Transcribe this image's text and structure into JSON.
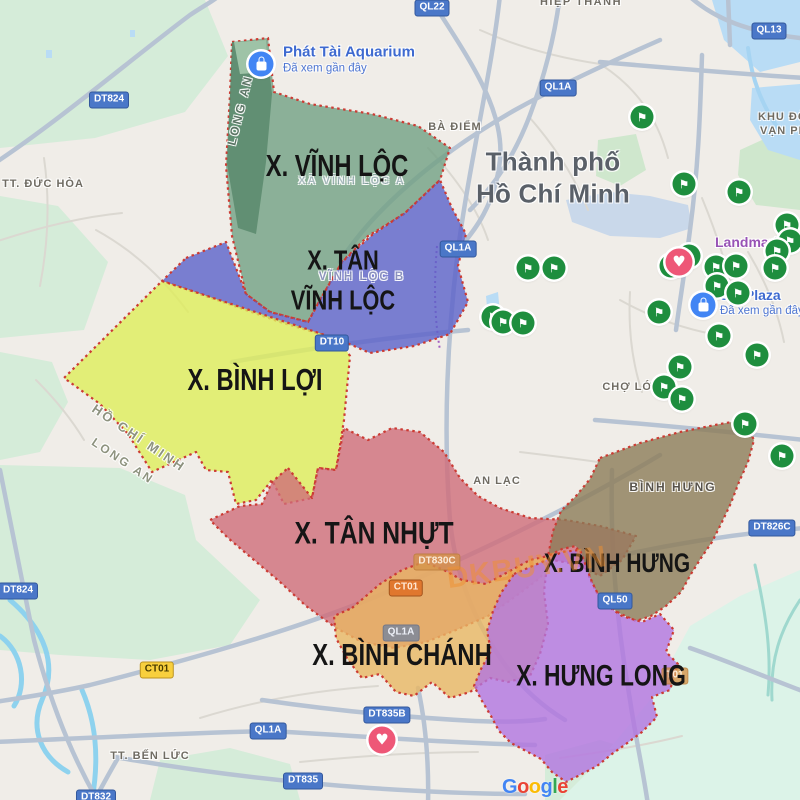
{
  "map": {
    "attribution": {
      "text": "Google",
      "x": 502,
      "y": 776,
      "letter_colors": [
        "#4285F4",
        "#EA4335",
        "#FBBC05",
        "#4285F4",
        "#34A853",
        "#EA4335"
      ]
    },
    "watermark": {
      "text": "DKBUY.VN",
      "color": "#f09030",
      "x": 527,
      "y": 568
    },
    "colors": {
      "region_border": "#cc3b33",
      "pin_flag": "#1e8e3e",
      "pin_heart": "#ee5777",
      "pin_bag": "#4285f4",
      "road_badge_blue": "#4a77c8",
      "road_badge_yellow": "#f8cf3d",
      "road_badge_orange": "#e0772e"
    },
    "regions": [
      {
        "id": "vinh-loc",
        "name": "X. Vĩnh Lộc",
        "color": "#72a083",
        "strip_color": "#598a6c",
        "tip_color": "#a9cdb0",
        "label_lines": [
          "X. VĨNH LỘC"
        ],
        "label_x": 337,
        "label_y": 167,
        "label_size": 25
      },
      {
        "id": "tan-vinh-loc",
        "name": "X. Tân Vĩnh Lộc",
        "color": "#5b62c9",
        "label_lines": [
          "X. TÂN",
          "VĨNH LỘC"
        ],
        "label_x": 343,
        "label_y": 280,
        "label_size": 23
      },
      {
        "id": "binh-loi",
        "name": "X. Bình Lợi",
        "color": "#dfed5a",
        "label_lines": [
          "X. BÌNH LỢI"
        ],
        "label_x": 255,
        "label_y": 381,
        "label_size": 25
      },
      {
        "id": "tan-nhut",
        "name": "X. Tân Nhựt",
        "color": "#d06d79",
        "label_lines": [
          "X. TÂN NHỰT"
        ],
        "label_x": 374,
        "label_y": 533,
        "label_size": 26
      },
      {
        "id": "binh-hung",
        "name": "X. Bình Hưng",
        "color": "#8c7c57",
        "label_lines": [
          "X. BÌNH HƯNG"
        ],
        "label_x": 617,
        "label_y": 563,
        "label_size": 22
      },
      {
        "id": "binh-chanh",
        "name": "X. Bình Chánh",
        "color": "#e9b763",
        "label_lines": [
          "X. BÌNH CHÁNH"
        ],
        "label_x": 402,
        "label_y": 656,
        "label_size": 25
      },
      {
        "id": "hung-long",
        "name": "X. Hưng Long",
        "color": "#b274e0",
        "label_lines": [
          "X. HƯNG LONG"
        ],
        "label_x": 601,
        "label_y": 677,
        "label_size": 24
      }
    ],
    "place_labels": [
      {
        "text": "HIỆP THÀNH",
        "x": 581,
        "y": 2,
        "spacing": 1.5
      },
      {
        "text": "BÀ ĐIỂM",
        "x": 455,
        "y": 127,
        "spacing": 1
      },
      {
        "text": "TT. ĐỨC HÒA",
        "x": 43,
        "y": 184,
        "spacing": 1
      },
      {
        "text": "KHU ĐÔ",
        "x": 758,
        "y": 117,
        "anchor": "left",
        "spacing": 1
      },
      {
        "text": "VẠN PH",
        "x": 760,
        "y": 131,
        "anchor": "left",
        "spacing": 1
      },
      {
        "text": "Thành phố",
        "x": 553,
        "y": 162,
        "cls": "city"
      },
      {
        "text": "Hồ Chí Minh",
        "x": 553,
        "y": 194,
        "cls": "city"
      },
      {
        "text": "CHỢ LỚN",
        "x": 632,
        "y": 387,
        "spacing": 1
      },
      {
        "text": "AN LẠC",
        "x": 497,
        "y": 481,
        "spacing": 1
      },
      {
        "text": "BÌNH HƯNG",
        "x": 673,
        "y": 487,
        "size": 12,
        "spacing": 2,
        "color": "#57524a"
      },
      {
        "text": "TT. BẾN LỨC",
        "x": 150,
        "y": 756,
        "spacing": 1
      },
      {
        "text": "LONG AN",
        "x": 240,
        "y": 110,
        "rotate": -76,
        "size": 12,
        "spacing": 2.5,
        "cls": "strip"
      },
      {
        "text": "HỒ CHÍ MINH",
        "x": 139,
        "y": 438,
        "rotate": 34,
        "size": 13,
        "spacing": 2.5,
        "cls": "prov"
      },
      {
        "text": "LONG AN",
        "x": 123,
        "y": 461,
        "rotate": 34,
        "size": 12,
        "spacing": 2.5,
        "cls": "prov"
      },
      {
        "text": "XÃ VĨNH LỘC A",
        "x": 352,
        "y": 181,
        "size": 11,
        "spacing": 2,
        "cls": "faint"
      },
      {
        "text": "VĨNH LỘC B",
        "x": 362,
        "y": 277,
        "size": 11.5,
        "spacing": 2,
        "cls": "faintblue"
      }
    ],
    "poi_labels": [
      {
        "name": "Phát Tài Aquarium",
        "sub": "Đã xem gần đây",
        "x": 283,
        "y": 59,
        "size": 15,
        "color": "#3e6ad0"
      },
      {
        "name": "Landmark",
        "x": 715,
        "y": 242,
        "size": 14,
        "color": "#9853b5"
      },
      {
        "name": "om Plaza",
        "sub": "Đã xem gần đây",
        "x": 720,
        "y": 302,
        "size": 14,
        "color": "#3e6ad0"
      }
    ],
    "road_badges": [
      {
        "text": "QL22",
        "x": 432,
        "y": 8,
        "cls": "b-blue"
      },
      {
        "text": "QL13",
        "x": 769,
        "y": 31,
        "cls": "b-blue"
      },
      {
        "text": "QL1A",
        "x": 558,
        "y": 88,
        "cls": "b-blue"
      },
      {
        "text": "DT824",
        "x": 109,
        "y": 100,
        "cls": "b-blue"
      },
      {
        "text": "QL1A",
        "x": 458,
        "y": 249,
        "cls": "b-blue"
      },
      {
        "text": "DT10",
        "x": 332,
        "y": 343,
        "cls": "b-blue"
      },
      {
        "text": "DT826C",
        "x": 772,
        "y": 528,
        "cls": "b-blue"
      },
      {
        "text": "DT830C",
        "x": 437,
        "y": 562,
        "cls": "b-fadedorange"
      },
      {
        "text": "CT01",
        "x": 406,
        "y": 588,
        "cls": "b-orange"
      },
      {
        "text": "QL50",
        "x": 615,
        "y": 601,
        "cls": "b-blue"
      },
      {
        "text": "QL1A",
        "x": 401,
        "y": 633,
        "cls": "b-fadedblue"
      },
      {
        "text": "CT01",
        "x": 157,
        "y": 670,
        "cls": "b-yellow"
      },
      {
        "text": "T01",
        "x": 675,
        "y": 676,
        "cls": "b-fadedorange"
      },
      {
        "text": "DT824",
        "x": 18,
        "y": 591,
        "cls": "b-blue"
      },
      {
        "text": "DT835B",
        "x": 387,
        "y": 715,
        "cls": "b-blue"
      },
      {
        "text": "QL1A",
        "x": 268,
        "y": 731,
        "cls": "b-blue"
      },
      {
        "text": "DT835",
        "x": 303,
        "y": 781,
        "cls": "b-blue"
      },
      {
        "text": "DT832",
        "x": 96,
        "y": 798,
        "cls": "b-blue"
      }
    ],
    "pins": [
      {
        "type": "flag",
        "x": 642,
        "y": 117
      },
      {
        "type": "flag",
        "x": 684,
        "y": 184
      },
      {
        "type": "flag",
        "x": 739,
        "y": 192
      },
      {
        "type": "flag",
        "x": 787,
        "y": 225
      },
      {
        "type": "flag",
        "x": 790,
        "y": 241
      },
      {
        "type": "flag",
        "x": 777,
        "y": 251
      },
      {
        "type": "flag",
        "x": 528,
        "y": 268
      },
      {
        "type": "flag",
        "x": 554,
        "y": 268
      },
      {
        "type": "flag",
        "x": 689,
        "y": 256
      },
      {
        "type": "flag",
        "x": 671,
        "y": 266
      },
      {
        "type": "flag",
        "x": 716,
        "y": 267
      },
      {
        "type": "flag",
        "x": 736,
        "y": 266
      },
      {
        "type": "flag",
        "x": 775,
        "y": 268
      },
      {
        "type": "flag",
        "x": 717,
        "y": 286
      },
      {
        "type": "flag",
        "x": 738,
        "y": 293
      },
      {
        "type": "flag",
        "x": 493,
        "y": 317
      },
      {
        "type": "flag",
        "x": 503,
        "y": 322
      },
      {
        "type": "flag",
        "x": 523,
        "y": 323
      },
      {
        "type": "flag",
        "x": 659,
        "y": 312
      },
      {
        "type": "flag",
        "x": 719,
        "y": 336
      },
      {
        "type": "flag",
        "x": 757,
        "y": 355
      },
      {
        "type": "flag",
        "x": 680,
        "y": 367
      },
      {
        "type": "flag",
        "x": 664,
        "y": 387
      },
      {
        "type": "flag",
        "x": 682,
        "y": 399
      },
      {
        "type": "flag",
        "x": 745,
        "y": 424
      },
      {
        "type": "flag",
        "x": 782,
        "y": 456
      },
      {
        "type": "bag",
        "x": 261,
        "y": 64
      },
      {
        "type": "bag",
        "x": 703,
        "y": 305
      },
      {
        "type": "heart",
        "x": 679,
        "y": 262
      },
      {
        "type": "heart",
        "x": 382,
        "y": 740
      }
    ]
  }
}
